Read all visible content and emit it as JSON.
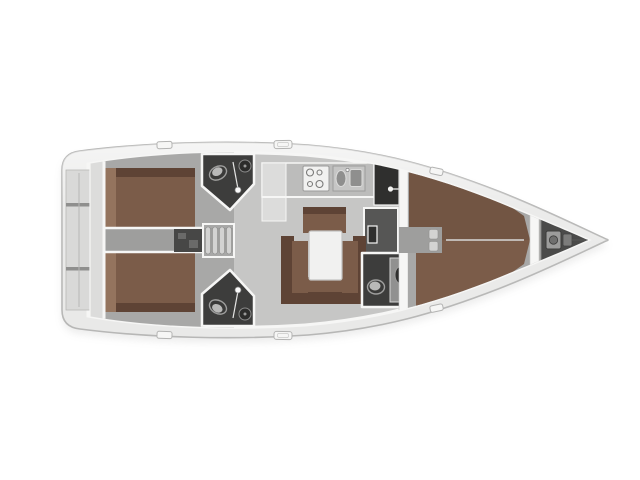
{
  "figure": {
    "type": "sailing-yacht-interior-floor-plan",
    "description": "Top-down rendered interior layout plan of a sailing yacht, bow pointing right, on a white background"
  },
  "colors": {
    "background": "#ffffff",
    "hull_deck": "#e9e9e8",
    "hull_edge": "#b7b7b6",
    "wall_white": "#f6f6f5",
    "floor_salon": "#c6c6c5",
    "floor_cabin": "#a8a8a7",
    "floor_corridor": "#9e9e9d",
    "berth_brown": "#7b5c49",
    "berth_brown_dark": "#5e4335",
    "berth_brown_light": "#94745e",
    "head_floor_dark": "#3d3d3c",
    "counter_gray": "#bcbcbb",
    "counter_light": "#dcdcdb",
    "cabinet_dark": "#2f2f2e",
    "cabinet_gray": "#919190",
    "nav_floor": "#565655",
    "engine_dark": "#474746",
    "fixture_white": "#f1f1f0",
    "fixture_gray": "#8f8f8e",
    "steps_light": "#d3d3d2",
    "locker_dark": "#4b4b4a",
    "platform_gray": "#d9d9d8"
  },
  "rooms": {
    "hull": "Yacht hull, bow pointing right",
    "stern_platform": "Stern transom with swim platform steps",
    "aft_bulkhead": "Aft bulkhead lockers",
    "aft_cabin_port": "Aft double cabin, port side",
    "aft_cabin_starboard": "Aft double cabin, starboard side",
    "engine_companionway": "Engine compartment and companionway steps",
    "aft_head_port": "Aft head with shower and toilet, port side",
    "aft_head_starboard": "Aft head with shower and toilet, starboard side",
    "galley": "Galley with stove and twin sinks",
    "fridge_cabinet": "Refrigerator cabinet",
    "nav_area": "Navigation / wet locker area",
    "salon": "Salon with U-shaped settee and table",
    "salon_table": "Salon table",
    "forward_head": "Forward head with toilet and washbasin",
    "main_bulkhead": "Forward cabin bulkhead with door opening",
    "forward_cabin": "Forward cabin with island double berth",
    "bow_bulkhead": "Collision bulkhead",
    "anchor_locker": "Anchor locker with windlass",
    "deck_hatches": "Deck hatches along the side decks"
  }
}
